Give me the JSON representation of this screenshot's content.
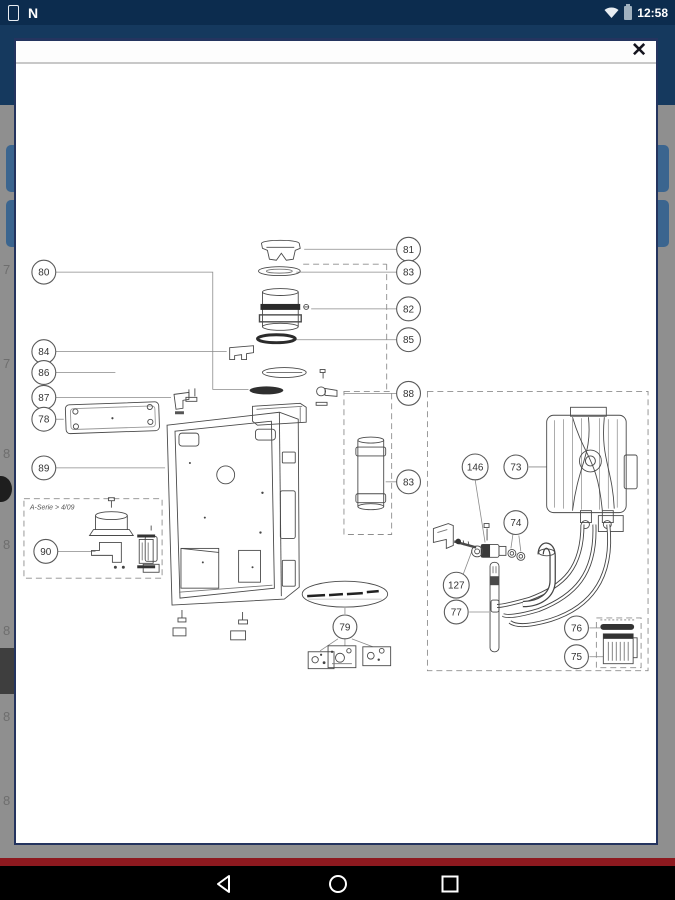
{
  "status_bar": {
    "time": "12:58",
    "nfc_label": "N",
    "left_icons": [
      "device-icon",
      "nfc-icon"
    ],
    "right_icons": [
      "wifi-icon",
      "battery-icon"
    ]
  },
  "modal": {
    "close_label": "✕"
  },
  "diagram": {
    "series_label": "A-Serie > 4/09",
    "callouts": {
      "c80": "80",
      "c81": "81",
      "c82": "82",
      "c83a": "83",
      "c83b": "83",
      "c84": "84",
      "c85": "85",
      "c86": "86",
      "c87": "87",
      "c78": "78",
      "c88": "88",
      "c89": "89",
      "c90": "90",
      "c79": "79",
      "c146": "146",
      "c73": "73",
      "c74": "74",
      "c127": "127",
      "c77": "77",
      "c76": "76",
      "c75": "75"
    }
  },
  "underlay": {
    "row_labels": [
      "7",
      "7",
      "8",
      "8",
      "8",
      "8",
      "8"
    ]
  },
  "nav_bar": {
    "buttons": [
      "back",
      "home",
      "recents"
    ]
  },
  "colors": {
    "status_bar_bg": "#0c2c4e",
    "app_header_bg": "#15395e",
    "scrim_gray": "#8f8f8f",
    "button_blue": "#3b658f",
    "footer_red": "#8d191f",
    "modal_border": "#24345f"
  }
}
